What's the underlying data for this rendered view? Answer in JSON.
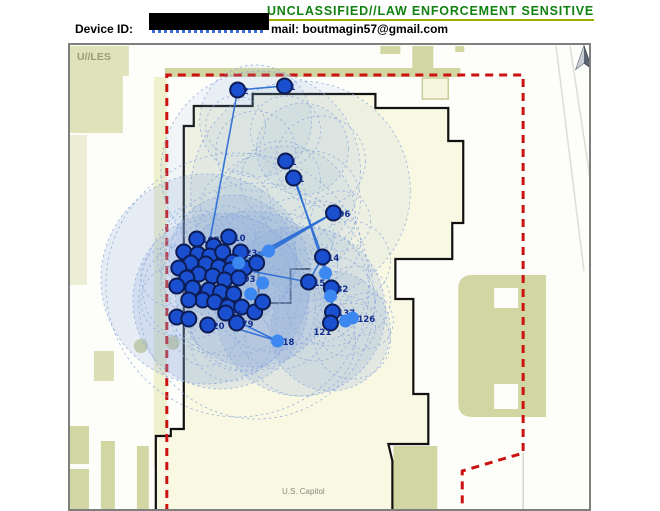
{
  "header": {
    "classification": "UNCLASSIFIED//LAW ENFORCEMENT SENSITIVE",
    "device_id_label": "Device ID:",
    "email_text": "mail: boutmagin57@gmail.com"
  },
  "map": {
    "watermark": "U//LES",
    "place_label": "U.S. Capitol",
    "colors": {
      "classification_green": "#128212",
      "boundary_red": "#cc1111",
      "dot_dark": "#1a4fd0",
      "dot_dark_stroke": "#0c1c52",
      "dot_light": "#3d87f0",
      "track_line": "#2e6fd6",
      "accuracy_stroke": "#8fabdd",
      "accuracy_fill": "rgba(130,165,220,0.22)",
      "accuracy_fill_faint": "rgba(130,165,220,0.10)",
      "land_khaki": "#d2d6a2",
      "building_fill": "#f9f9e3",
      "label_blue": "#122d8e"
    },
    "points": [
      {
        "x": 196,
        "y": 238,
        "label": "108",
        "type": "dark"
      },
      {
        "x": 228,
        "y": 236,
        "label": "10",
        "type": "dark"
      },
      {
        "x": 213,
        "y": 245,
        "label": "",
        "type": "dark"
      },
      {
        "x": 183,
        "y": 251,
        "label": "62",
        "type": "dark"
      },
      {
        "x": 197,
        "y": 253,
        "label": "",
        "type": "dark"
      },
      {
        "x": 209,
        "y": 255,
        "label": "",
        "type": "dark"
      },
      {
        "x": 222,
        "y": 251,
        "label": "",
        "type": "dark"
      },
      {
        "x": 240,
        "y": 251,
        "label": "23",
        "type": "dark"
      },
      {
        "x": 232,
        "y": 261,
        "label": "",
        "type": "dark"
      },
      {
        "x": 205,
        "y": 263,
        "label": "",
        "type": "dark"
      },
      {
        "x": 190,
        "y": 262,
        "label": "",
        "type": "dark"
      },
      {
        "x": 178,
        "y": 267,
        "label": "",
        "type": "dark"
      },
      {
        "x": 218,
        "y": 266,
        "label": "",
        "type": "dark"
      },
      {
        "x": 230,
        "y": 269,
        "label": "",
        "type": "dark"
      },
      {
        "x": 244,
        "y": 267,
        "label": "",
        "type": "dark"
      },
      {
        "x": 256,
        "y": 262,
        "label": "",
        "type": "dark"
      },
      {
        "x": 198,
        "y": 273,
        "label": "",
        "type": "dark"
      },
      {
        "x": 212,
        "y": 275,
        "label": "",
        "type": "dark"
      },
      {
        "x": 186,
        "y": 277,
        "label": "",
        "type": "dark"
      },
      {
        "x": 224,
        "y": 279,
        "label": "",
        "type": "dark"
      },
      {
        "x": 238,
        "y": 277,
        "label": "93",
        "type": "dark"
      },
      {
        "x": 176,
        "y": 285,
        "label": "",
        "type": "dark"
      },
      {
        "x": 192,
        "y": 287,
        "label": "",
        "type": "dark"
      },
      {
        "x": 208,
        "y": 289,
        "label": "",
        "type": "dark"
      },
      {
        "x": 220,
        "y": 291,
        "label": "",
        "type": "dark"
      },
      {
        "x": 233,
        "y": 293,
        "label": "",
        "type": "dark"
      },
      {
        "x": 202,
        "y": 299,
        "label": "",
        "type": "dark"
      },
      {
        "x": 214,
        "y": 301,
        "label": "12",
        "type": "dark"
      },
      {
        "x": 188,
        "y": 299,
        "label": "",
        "type": "dark"
      },
      {
        "x": 227,
        "y": 306,
        "label": "",
        "type": "dark"
      },
      {
        "x": 241,
        "y": 306,
        "label": "",
        "type": "dark"
      },
      {
        "x": 225,
        "y": 312,
        "label": "31",
        "type": "dark"
      },
      {
        "x": 176,
        "y": 316,
        "label": "3",
        "type": "dark"
      },
      {
        "x": 188,
        "y": 318,
        "label": "",
        "type": "dark"
      },
      {
        "x": 207,
        "y": 324,
        "label": "20",
        "type": "dark"
      },
      {
        "x": 236,
        "y": 322,
        "label": "79",
        "type": "dark"
      },
      {
        "x": 254,
        "y": 311,
        "label": "",
        "type": "dark"
      },
      {
        "x": 262,
        "y": 301,
        "label": "",
        "type": "dark"
      },
      {
        "x": 268,
        "y": 250,
        "label": "",
        "type": "light"
      },
      {
        "x": 238,
        "y": 262,
        "label": "",
        "type": "light"
      },
      {
        "x": 250,
        "y": 293,
        "label": "",
        "type": "light"
      },
      {
        "x": 262,
        "y": 282,
        "label": "",
        "type": "light"
      },
      {
        "x": 237,
        "y": 89,
        "label": "2",
        "type": "dark"
      },
      {
        "x": 284,
        "y": 85,
        "label": "1",
        "type": "dark"
      },
      {
        "x": 285,
        "y": 160,
        "label": "1",
        "type": "dark"
      },
      {
        "x": 293,
        "y": 177,
        "label": "1",
        "type": "dark"
      },
      {
        "x": 333,
        "y": 212,
        "label": "96",
        "type": "dark"
      },
      {
        "x": 322,
        "y": 256,
        "label": "14",
        "type": "dark"
      },
      {
        "x": 325,
        "y": 272,
        "label": "",
        "type": "light"
      },
      {
        "x": 308,
        "y": 281,
        "label": "15",
        "type": "dark"
      },
      {
        "x": 331,
        "y": 287,
        "label": "32",
        "type": "dark"
      },
      {
        "x": 330,
        "y": 295,
        "label": "",
        "type": "light"
      },
      {
        "x": 332,
        "y": 311,
        "label": "137",
        "type": "dark"
      },
      {
        "x": 330,
        "y": 322,
        "label": "121",
        "type": "dark",
        "lx": -17,
        "ly": 12
      },
      {
        "x": 345,
        "y": 320,
        "label": "",
        "type": "light"
      },
      {
        "x": 352,
        "y": 317,
        "label": "126",
        "type": "light"
      },
      {
        "x": 277,
        "y": 340,
        "label": "18",
        "type": "light"
      }
    ],
    "segments": [
      [
        237,
        89,
        284,
        85
      ],
      [
        237,
        89,
        204,
        267
      ],
      [
        285,
        160,
        293,
        177
      ],
      [
        293,
        177,
        322,
        256
      ],
      [
        295,
        179,
        325,
        272
      ],
      [
        333,
        212,
        240,
        262
      ],
      [
        333,
        212,
        231,
        270
      ],
      [
        333,
        212,
        223,
        278
      ],
      [
        322,
        256,
        308,
        281
      ],
      [
        308,
        281,
        250,
        270
      ],
      [
        322,
        256,
        331,
        287
      ],
      [
        331,
        287,
        332,
        311
      ],
      [
        330,
        295,
        332,
        311
      ],
      [
        277,
        340,
        238,
        321
      ],
      [
        277,
        340,
        234,
        327
      ]
    ],
    "circles": [
      [
        205,
        278,
        105,
        1
      ],
      [
        220,
        300,
        88,
        1
      ],
      [
        252,
        288,
        78,
        1
      ],
      [
        232,
        258,
        64,
        1
      ],
      [
        300,
        310,
        85,
        1
      ],
      [
        330,
        330,
        60,
        1
      ],
      [
        285,
        215,
        70,
        2
      ],
      [
        255,
        120,
        56,
        2
      ],
      [
        302,
        148,
        46,
        2
      ],
      [
        300,
        190,
        110,
        2
      ],
      [
        260,
        170,
        100,
        2
      ],
      [
        237,
        284,
        132,
        0
      ],
      [
        256,
        300,
        118,
        0
      ],
      [
        200,
        250,
        40,
        0
      ],
      [
        215,
        270,
        55,
        0
      ],
      [
        190,
        290,
        48,
        0
      ],
      [
        230,
        285,
        70,
        0
      ],
      [
        250,
        260,
        45,
        0
      ],
      [
        270,
        290,
        60,
        0
      ],
      [
        210,
        310,
        42,
        0
      ],
      [
        240,
        320,
        50,
        0
      ],
      [
        260,
        240,
        35,
        0
      ],
      [
        285,
        265,
        52,
        0
      ],
      [
        310,
        285,
        58,
        0
      ],
      [
        330,
        300,
        45,
        0
      ],
      [
        345,
        325,
        30,
        0
      ],
      [
        320,
        240,
        40,
        0
      ],
      [
        295,
        235,
        38,
        0
      ],
      [
        225,
        235,
        30,
        0
      ],
      [
        185,
        260,
        28,
        0
      ],
      [
        175,
        300,
        35,
        0
      ],
      [
        250,
        305,
        65,
        0
      ],
      [
        280,
        320,
        48,
        0
      ],
      [
        300,
        340,
        55,
        0
      ],
      [
        230,
        340,
        40,
        0
      ],
      [
        205,
        335,
        30,
        0
      ],
      [
        260,
        200,
        45,
        0
      ],
      [
        235,
        205,
        35,
        0
      ],
      [
        280,
        180,
        40,
        0
      ],
      [
        310,
        200,
        50,
        0
      ],
      [
        255,
        150,
        40,
        0
      ],
      [
        285,
        130,
        35,
        0
      ],
      [
        235,
        125,
        30,
        0
      ],
      [
        320,
        160,
        45,
        0
      ],
      [
        350,
        260,
        40,
        0
      ],
      [
        355,
        300,
        35,
        0
      ],
      [
        365,
        320,
        28,
        0
      ],
      [
        190,
        230,
        25,
        0
      ],
      [
        170,
        275,
        30,
        0
      ],
      [
        340,
        220,
        30,
        0
      ],
      [
        352,
        340,
        38,
        0
      ],
      [
        315,
        320,
        40,
        0
      ]
    ]
  }
}
